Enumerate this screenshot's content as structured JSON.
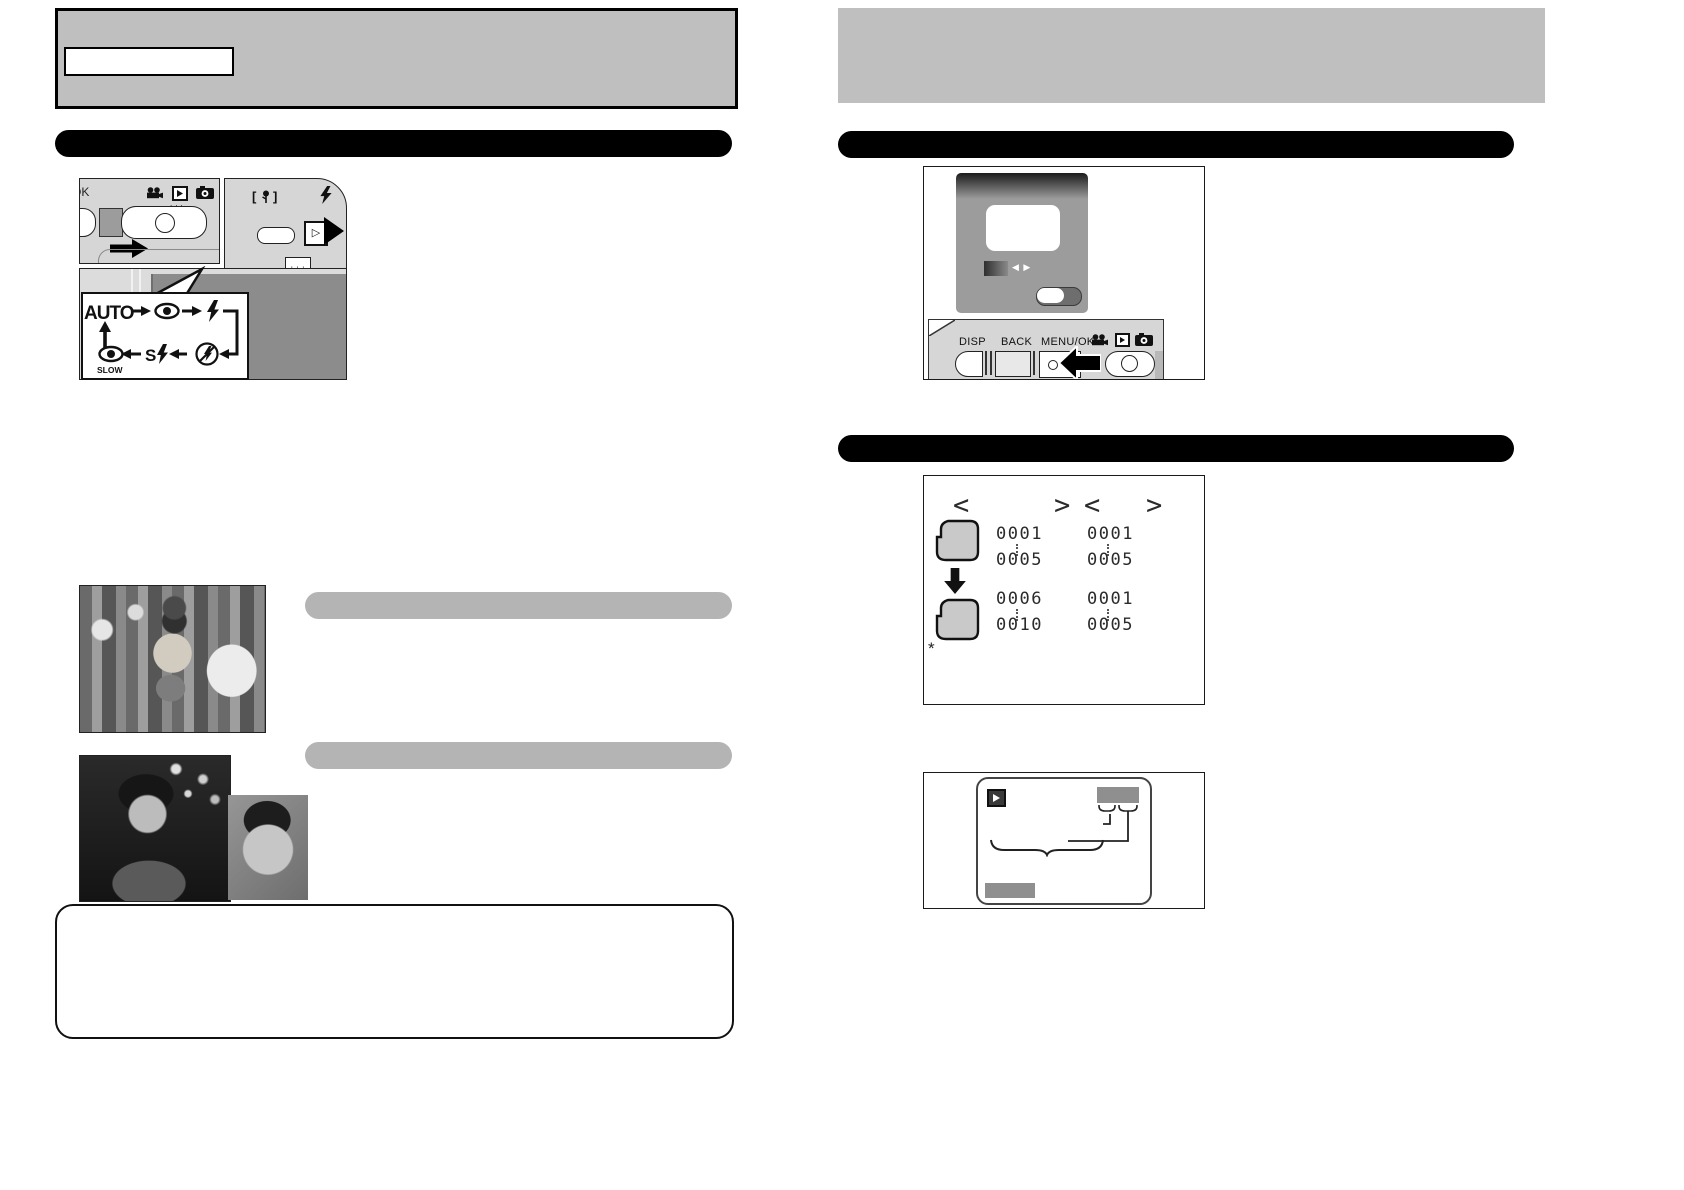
{
  "colors": {
    "panel_gray": "#bfbfbf",
    "bar_black": "#000000",
    "pill_gray": "#b4b4b4",
    "body_gray": "#d6d6d6",
    "lcd_gray": "#9c9c9c",
    "screen_dark": "#8c8c8c",
    "ink": "#111111"
  },
  "left": {
    "header_label": "",
    "camera_top": {
      "ok": "OK",
      "flash_select": "▷",
      "tele_marks": "+++"
    },
    "flash_cycle": {
      "auto": "AUTO",
      "slow": "SLOW",
      "s": "S"
    }
  },
  "right": {
    "lcd_nav": "◀ ▶",
    "panel_labels": {
      "disp": "DISP",
      "back": "BACK",
      "menu_ok": "MENU/OK"
    },
    "frame_table": {
      "headers": {
        "open1": "<",
        "close1": ">",
        "open2": "<",
        "close2": ">"
      },
      "groups": [
        {
          "c1a": "0001",
          "c1b": "0005",
          "c2a": "0001",
          "c2b": "0005"
        },
        {
          "c1a": "0006",
          "c1b": "0010",
          "c2a": "0001",
          "c2b": "0005"
        }
      ],
      "footnote": "*"
    }
  }
}
